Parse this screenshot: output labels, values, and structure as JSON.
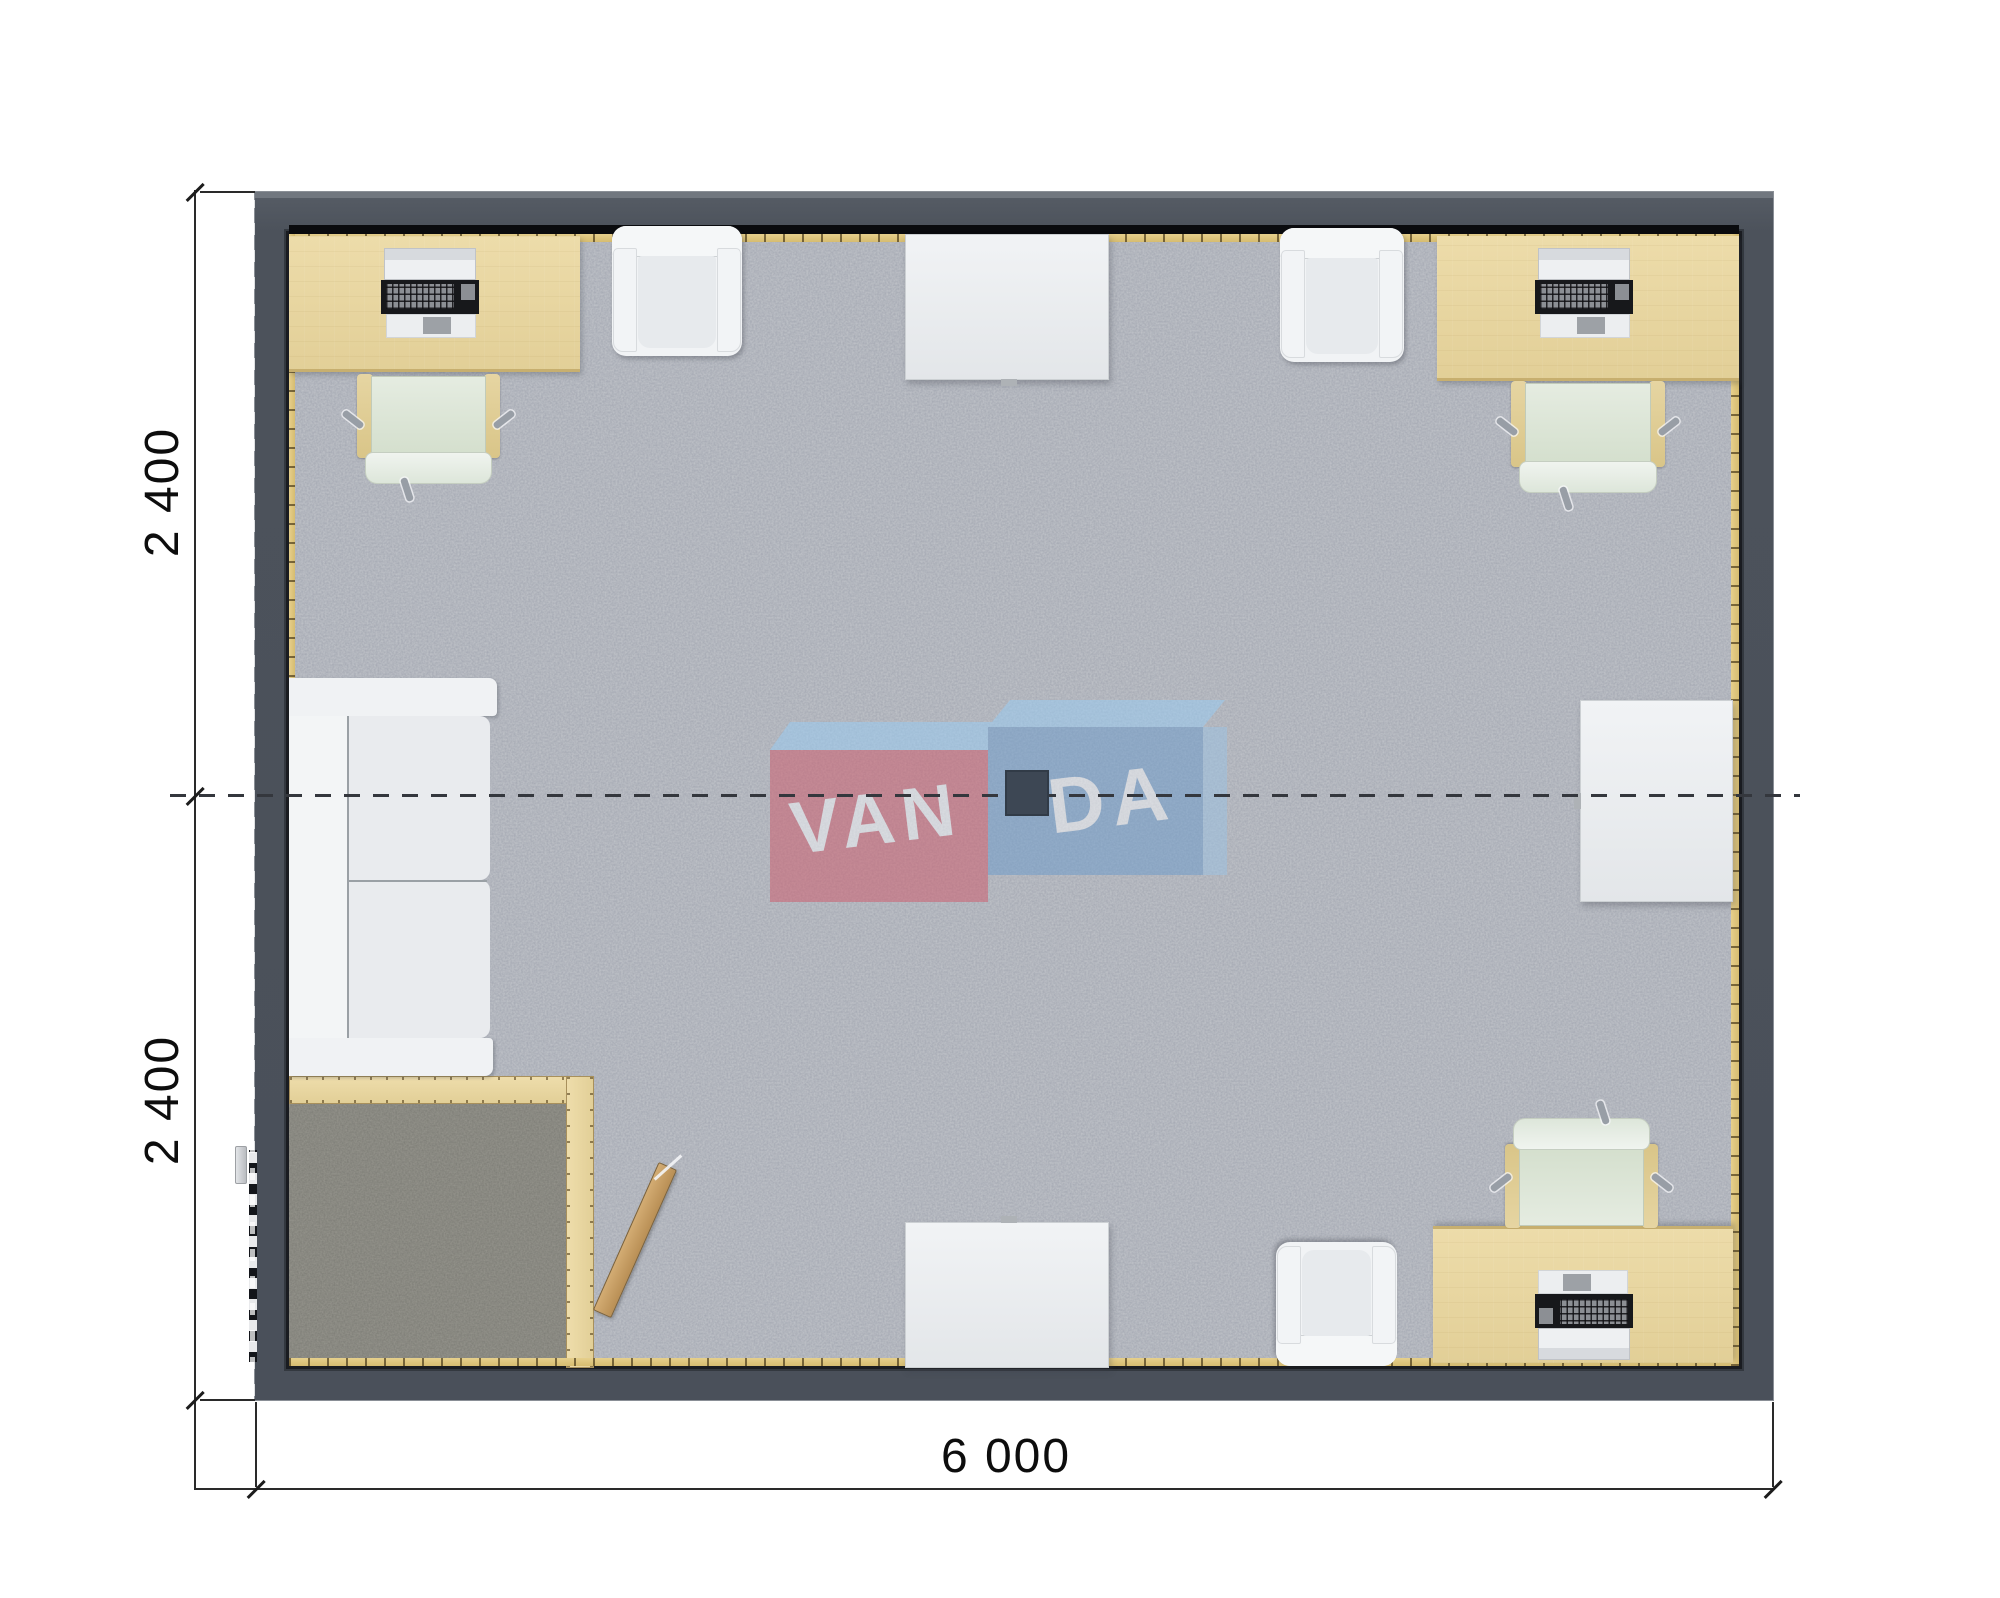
{
  "page": {
    "type": "architectural floor plan render",
    "background": "#ffffff"
  },
  "dimensions": {
    "width_label": "6 000",
    "height_top_label": "2 400",
    "height_bottom_label": "2 400"
  },
  "watermark": {
    "left_text": "VAN",
    "right_text": "DA",
    "full_name": "VANDA",
    "pink": "#cf5b6b",
    "blue": "#6d9ccc",
    "light_blue_top": "#99cdf5"
  },
  "colors": {
    "wall": "#4c525b",
    "carpet": "#c3c6cb",
    "vestibule_carpet": "#98978f",
    "desk_beige": "#e7d6a1",
    "skirting": "#dfc77e",
    "chair_seat_mint": "#dce5d6",
    "furniture_white": "#eef0f2",
    "door_wood": "#c8a269",
    "lamp": "#3d4754",
    "dimension_text": "#0d0d0d"
  },
  "furniture": {
    "desks": [
      "desk-top-left",
      "desk-top-right",
      "desk-bottom-right"
    ],
    "computers": [
      "computer-top-left",
      "computer-top-right",
      "computer-bottom-right"
    ],
    "office_chairs": [
      "office-chair-top-left",
      "office-chair-top-right",
      "office-chair-bottom-right"
    ],
    "armchairs": [
      "armchair-top-left",
      "armchair-top-right",
      "armchair-bottom-right"
    ],
    "tables": [
      "table-top-center",
      "table-right-middle",
      "table-bottom-center"
    ],
    "sofa": "sofa-left-wall",
    "vestibule": "entry-vestibule",
    "doors": [
      "entry-door-left-wall",
      "vestibule-door-open"
    ]
  }
}
